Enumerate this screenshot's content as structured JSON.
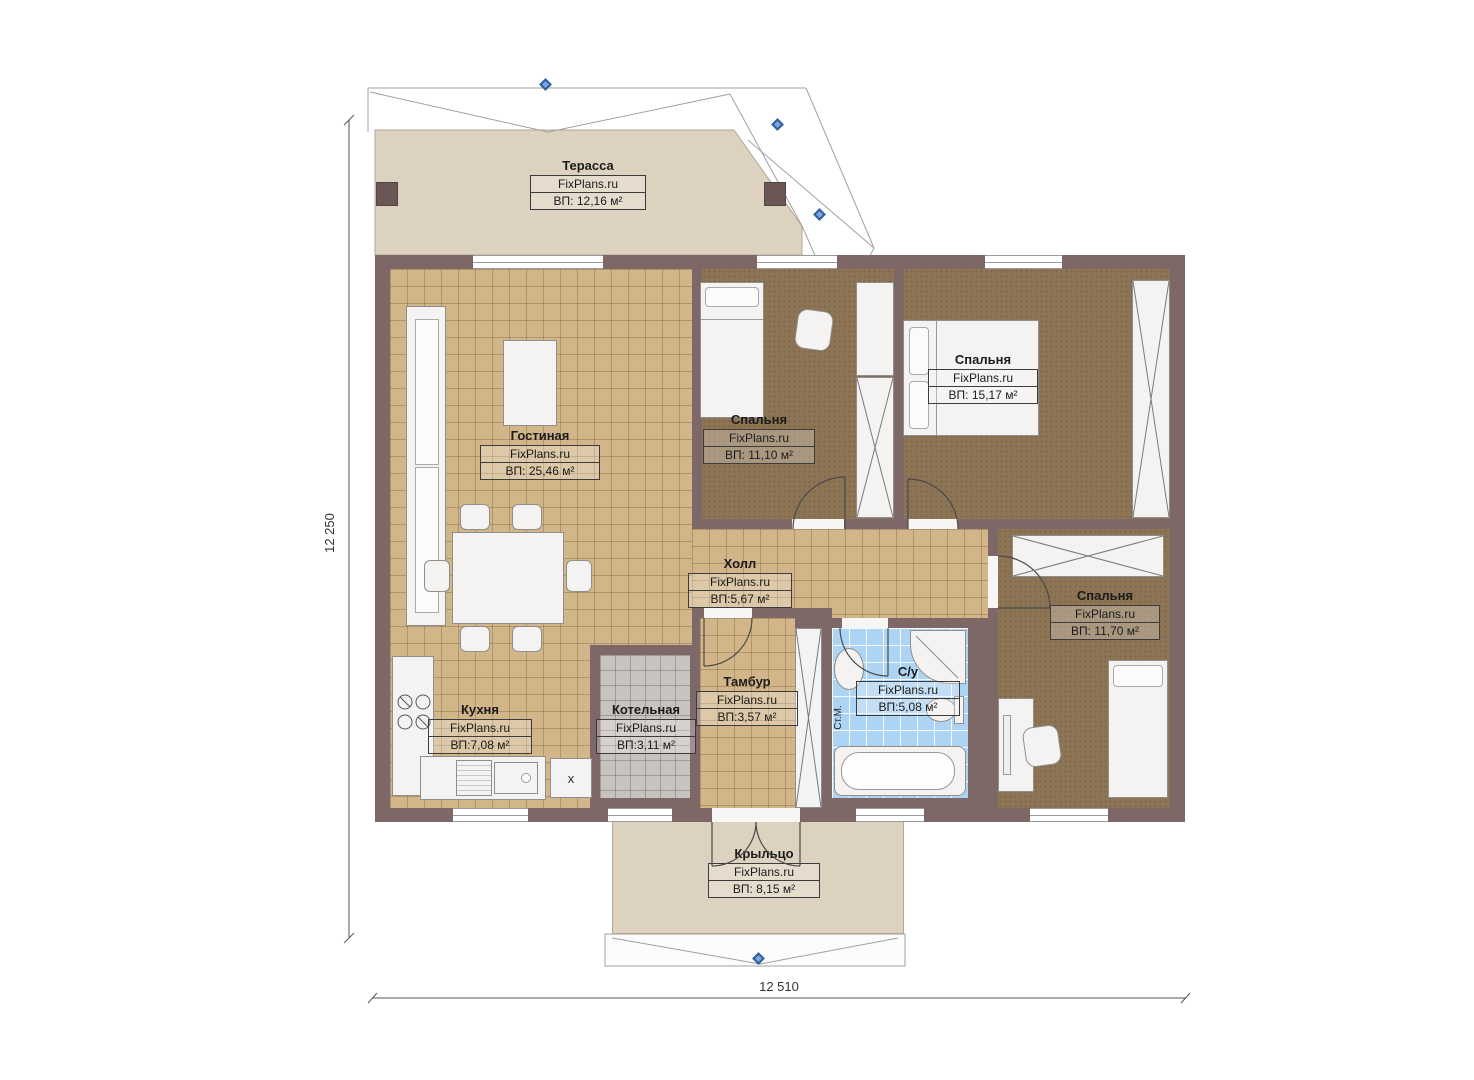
{
  "brand": "FixPlans.ru",
  "rooms": [
    {
      "name": "Терасса",
      "area": "ВП: 12,16 м²"
    },
    {
      "name": "Гостиная",
      "area": "ВП: 25,46 м²"
    },
    {
      "name": "Спальня",
      "area": "ВП: 11,10 м²"
    },
    {
      "name": "Спальня",
      "area": "ВП: 15,17 м²"
    },
    {
      "name": "Холл",
      "area": "ВП:5,67 м²"
    },
    {
      "name": "Спальня",
      "area": "ВП: 11,70 м²"
    },
    {
      "name": "Кухня",
      "area": "ВП:7,08 м²"
    },
    {
      "name": "Котельная",
      "area": "ВП:3,11 м²"
    },
    {
      "name": "Тамбур",
      "area": "ВП:3,57 м²"
    },
    {
      "name": "С/у",
      "area": "ВП:5,08 м²"
    },
    {
      "name": "Крыльцо",
      "area": "ВП: 8,15 м²"
    }
  ],
  "dimensions": {
    "left": "12 250",
    "bottom": "12 510"
  },
  "annotations": {
    "washing_machine": "Ст.М.",
    "fridge_mark": "x"
  },
  "colors": {
    "wall": "#7d6767",
    "floor_tile_tan": "#d2b68a",
    "floor_carpet_brown": "#8d7454",
    "floor_terrace_beige": "#ddd1bf",
    "floor_bath_blue": "#aed4f4",
    "floor_boiler_gray": "#c7c3bf",
    "marker_blue": "#2e5e9e"
  }
}
